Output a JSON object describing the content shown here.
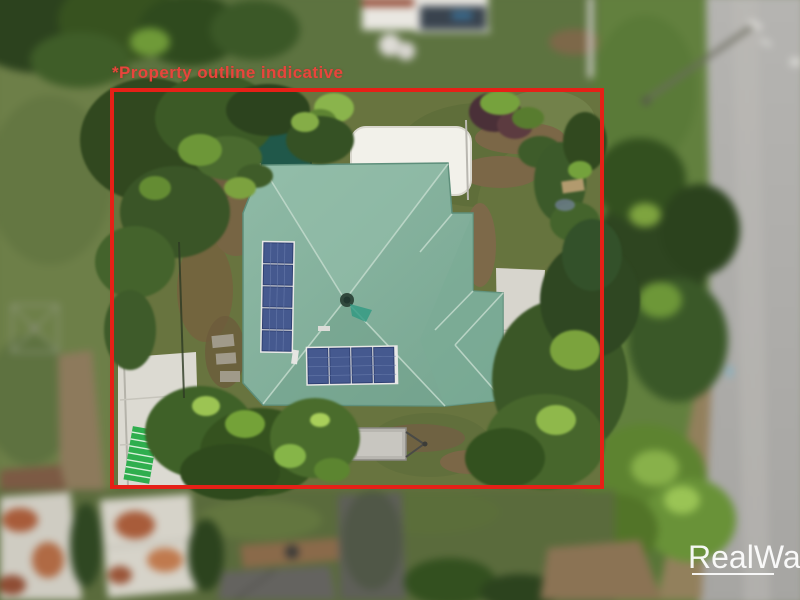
{
  "photo": {
    "kind": "aerial-drone-photo",
    "subject": "residential property with green hip roof, solar panels and highlighted boundary",
    "palette": {
      "roof_green": "#85b3a0",
      "shed_teal": "#20584a",
      "solar_blue": "#45598f",
      "lawn_olive": "#68743f",
      "road_gray": "#adacaa",
      "canopy_white": "#f2f1ea"
    },
    "objects": [
      "house-roof",
      "solar-array-left",
      "solar-array-rear",
      "garden-shed",
      "white-canopy",
      "box-trailer",
      "driveway-pad",
      "ladder",
      "street-road",
      "power-pole",
      "clothesline",
      "neighbour-roofs",
      "trees"
    ]
  },
  "overlay": {
    "disclaimer_text": "*Property outline indicative",
    "outline_color": "#e62017",
    "text_color": "#e8453c"
  },
  "watermark": {
    "brand_text": "RealWay",
    "color": "#ffffff"
  }
}
